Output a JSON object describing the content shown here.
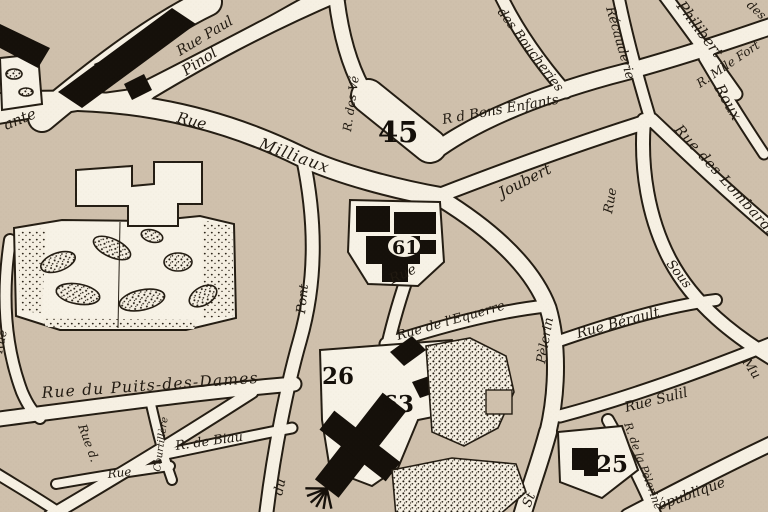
{
  "map": {
    "type": "vintage-engraved-city-plan",
    "colors": {
      "paper_road": "#f6f0e3",
      "block_beige": "#cfc0ac",
      "ink_outline": "#241d13",
      "building_black": "#15100a"
    },
    "street_labels": {
      "ante": "ante",
      "pinol": "Pinol",
      "rue_paul": "Rue Paul",
      "rue_of_milliaux": "Rue",
      "milliaux": "Milliaux",
      "rue_des_ve": "R. des Vé",
      "r_d_bons_enfants": "R d Bons Enfants",
      "des_boucheries": "des Boucheries",
      "recauderie": "Récauderie",
      "philibert": "Philibert",
      "r_mlle_fort": "R. Mlle Fort",
      "roux": "Roux",
      "des_corner": "des",
      "rue_des_lombards": "Rue des Lombards",
      "rue_of_sous": "Rue",
      "sous": "Sous",
      "joubert": "Joubert",
      "rue_under_61": "Rue",
      "pont": "Pont",
      "rue_de_lequerre": "Rue de l'Equerre",
      "pelerin": "Pèlerin",
      "rue_berault": "Rue Bérault",
      "mu": "Mu",
      "rue_sulil": "Rue Sulil",
      "rue_left_edge": "Rue",
      "rue_du_puits_des_dames": "Rue du Puits-des-Dames",
      "r_de_biau": "R. de Biau",
      "courtillere": "Courtillère",
      "rue_small": "Rue",
      "rue_d": "Rue d.",
      "du": "du",
      "r_de_la_pelerine": "R. de la Pèlerine",
      "republique": "épublique",
      "st": "St"
    },
    "parcel_numbers": {
      "n45": "45",
      "n61": "61",
      "n26": "26",
      "n63": "63",
      "n25": "25"
    }
  }
}
